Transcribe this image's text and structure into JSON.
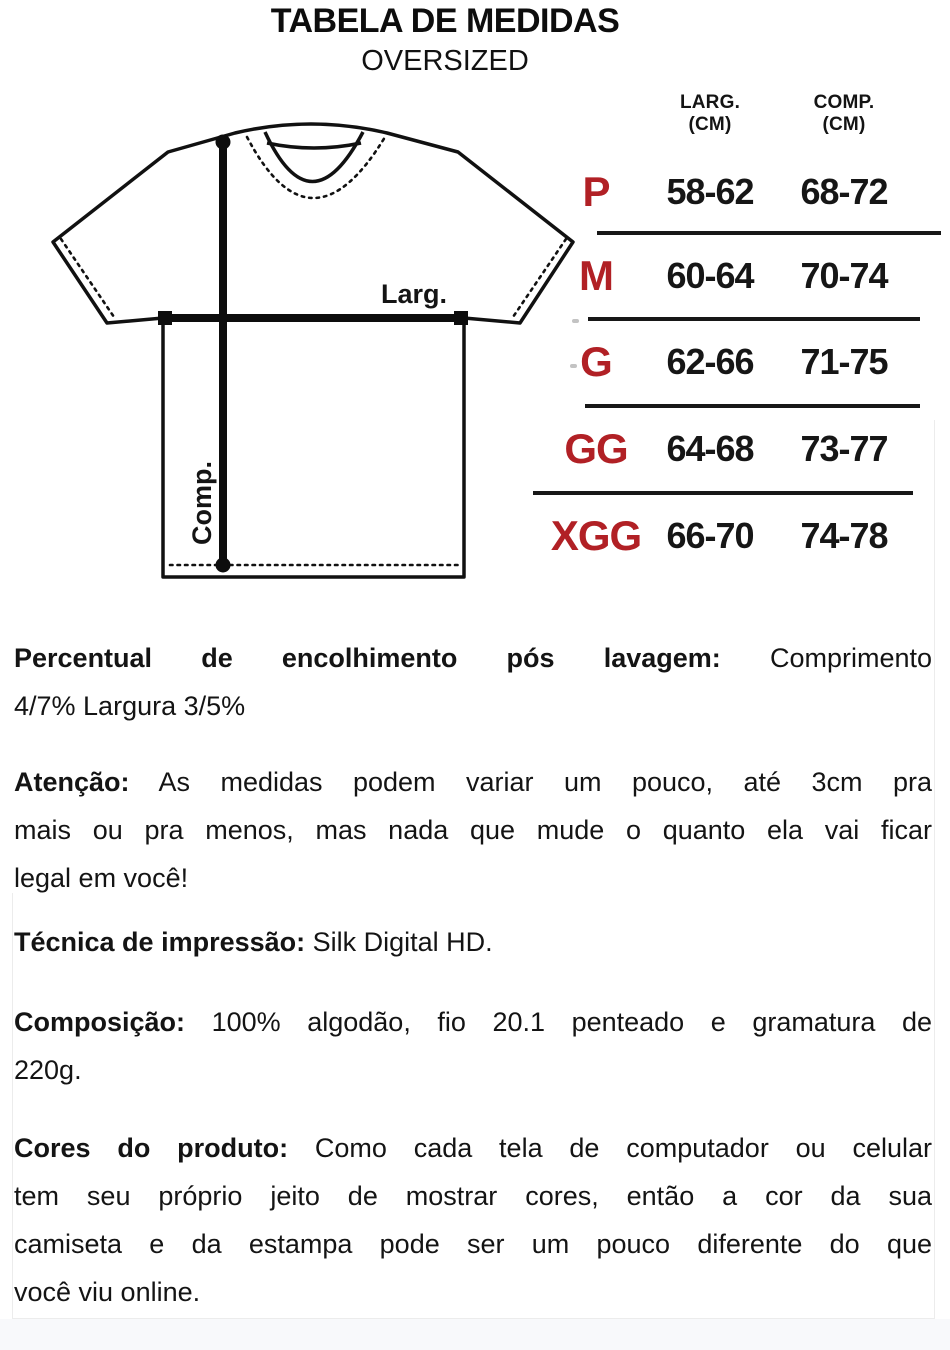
{
  "page": {
    "title": "TABELA DE MEDIDAS",
    "subtitle": "OVERSIZED",
    "accent_color": "#b12025",
    "text_color": "#141414"
  },
  "diagram": {
    "width_label": "Larg.",
    "length_label": "Comp."
  },
  "size_table": {
    "headers": [
      {
        "line1": "LARG.",
        "line2": "(CM)"
      },
      {
        "line1": "COMP.",
        "line2": "(CM)"
      }
    ],
    "rows": [
      {
        "size": "P",
        "larg": "58-62",
        "comp": "68-72"
      },
      {
        "size": "M",
        "larg": "60-64",
        "comp": "70-74"
      },
      {
        "size": "G",
        "larg": "62-66",
        "comp": "71-75"
      },
      {
        "size": "GG",
        "larg": "64-68",
        "comp": "73-77"
      },
      {
        "size": "XGG",
        "larg": "66-70",
        "comp": "74-78"
      }
    ]
  },
  "notes": [
    {
      "label": "Percentual de encolhimento pós lavagem:",
      "lines": [
        "Comprimento",
        "4/7% Largura 3/5%"
      ]
    },
    {
      "label": "Atenção:",
      "lines": [
        "As medidas podem variar um pouco, até 3cm pra",
        "mais ou pra menos, mas nada que mude o quanto ela vai ficar",
        "legal em você!"
      ]
    },
    {
      "label": "Técnica de impressão:",
      "lines": [
        "Silk Digital HD."
      ]
    },
    {
      "label": "Composição:",
      "lines": [
        "100% algodão, fio 20.1 penteado e gramatura de",
        "220g."
      ]
    },
    {
      "label": "Cores do produto:",
      "lines": [
        "Como cada tela de computador ou celular",
        "tem seu próprio jeito de mostrar cores, então a cor da sua",
        "camiseta e da estampa pode ser um pouco diferente do que",
        "você viu online."
      ]
    }
  ]
}
